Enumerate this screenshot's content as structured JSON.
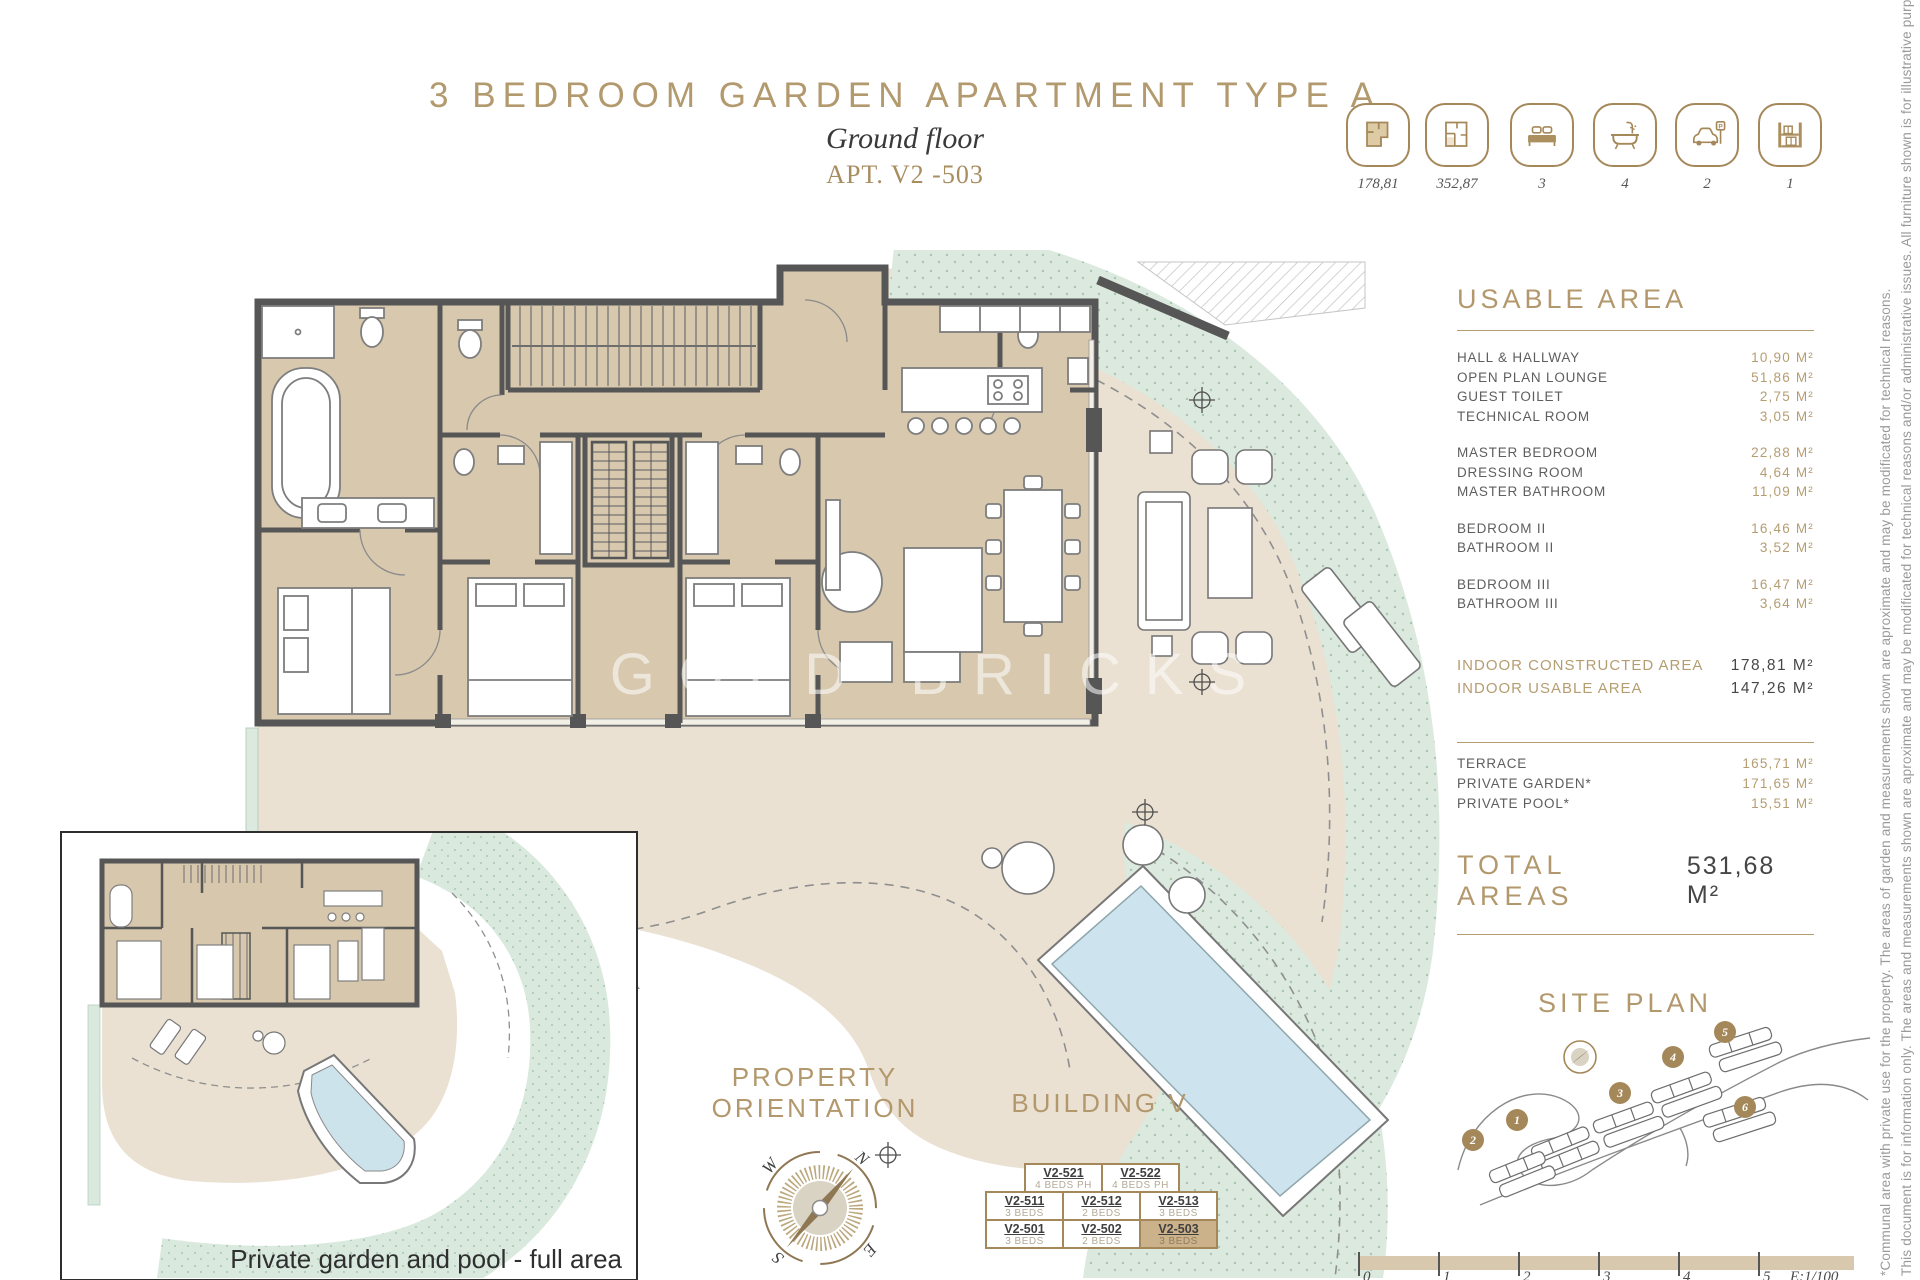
{
  "header": {
    "title": "3 BEDROOM GARDEN APARTMENT TYPE A",
    "subtitle": "Ground floor",
    "apt": "APT. V2 -503"
  },
  "stats": {
    "items": [
      {
        "icon": "indoor-area-icon",
        "value": "178,81"
      },
      {
        "icon": "built-area-icon",
        "value": "352,87"
      },
      {
        "icon": "bedrooms-icon",
        "value": "3"
      },
      {
        "icon": "bathrooms-icon",
        "value": "4"
      },
      {
        "icon": "parking-icon",
        "value": "2"
      },
      {
        "icon": "storage-icon",
        "value": "1"
      }
    ]
  },
  "usable_area": {
    "heading": "USABLE AREA",
    "rows1": [
      {
        "label": "HALL & HALLWAY",
        "value": "10,90 M²"
      },
      {
        "label": "OPEN PLAN LOUNGE",
        "value": "51,86 M²"
      },
      {
        "label": "GUEST TOILET",
        "value": "2,75 M²"
      },
      {
        "label": "TECHNICAL ROOM",
        "value": "3,05 M²"
      }
    ],
    "rows2": [
      {
        "label": "MASTER BEDROOM",
        "value": "22,88 M²"
      },
      {
        "label": "DRESSING ROOM",
        "value": "4,64 M²"
      },
      {
        "label": "MASTER BATHROOM",
        "value": "11,09 M²"
      }
    ],
    "rows3": [
      {
        "label": "BEDROOM II",
        "value": "16,46 M²"
      },
      {
        "label": "BATHROOM II",
        "value": "3,52 M²"
      }
    ],
    "rows4": [
      {
        "label": "BEDROOM III",
        "value": "16,47 M²"
      },
      {
        "label": "BATHROOM III",
        "value": "3,64 M²"
      }
    ],
    "summary": [
      {
        "label": "INDOOR CONSTRUCTED AREA",
        "value": "178,81 M²"
      },
      {
        "label": "INDOOR USABLE AREA",
        "value": "147,26 M²"
      }
    ],
    "outdoor": [
      {
        "label": "TERRACE",
        "value": "165,71 M²"
      },
      {
        "label": "PRIVATE GARDEN*",
        "value": "171,65 M²"
      },
      {
        "label": "PRIVATE POOL*",
        "value": "15,51 M²"
      }
    ],
    "total": {
      "label": "TOTAL AREAS",
      "value": "531,68 M²"
    }
  },
  "orientation": {
    "line1": "PROPERTY",
    "line2": "ORIENTATION",
    "compass": {
      "n": "N",
      "e": "E",
      "s": "S",
      "w": "W"
    }
  },
  "building": {
    "heading": "BUILDING V",
    "row1": [
      {
        "code": "V2-521",
        "beds": "4 BEDS PH"
      },
      {
        "code": "V2-522",
        "beds": "4 BEDS PH"
      }
    ],
    "row2": [
      {
        "code": "V2-511",
        "beds": "3 BEDS"
      },
      {
        "code": "V2-512",
        "beds": "2 BEDS"
      },
      {
        "code": "V2-513",
        "beds": "3 BEDS"
      }
    ],
    "row3": [
      {
        "code": "V2-501",
        "beds": "3 BEDS"
      },
      {
        "code": "V2-502",
        "beds": "2 BEDS"
      },
      {
        "code": "V2-503",
        "beds": "3 BEDS"
      }
    ],
    "highlighted_unit": "V2-503"
  },
  "site_plan": {
    "heading": "SITE PLAN",
    "markers": [
      "1",
      "2",
      "3",
      "4",
      "5",
      "6"
    ]
  },
  "scale_bar": {
    "ticks": [
      "0",
      "1",
      "2",
      "3",
      "4",
      "5"
    ],
    "scale": "E:1/100"
  },
  "inset": {
    "caption": "Private garden and pool - full area"
  },
  "watermark": {
    "text": "GOLD BRICKS"
  },
  "disclaimer": {
    "line1": "This document is for information only. The areas and measurements shown are aproximate and may be modificated for technical reasons and/or administrative issues. All furniture shown is for illustrative purposes.",
    "line2": "*Communal area with private use for the property. The areas of garden and measurements shown are aproximate and may be modificated for technical reasons."
  }
}
